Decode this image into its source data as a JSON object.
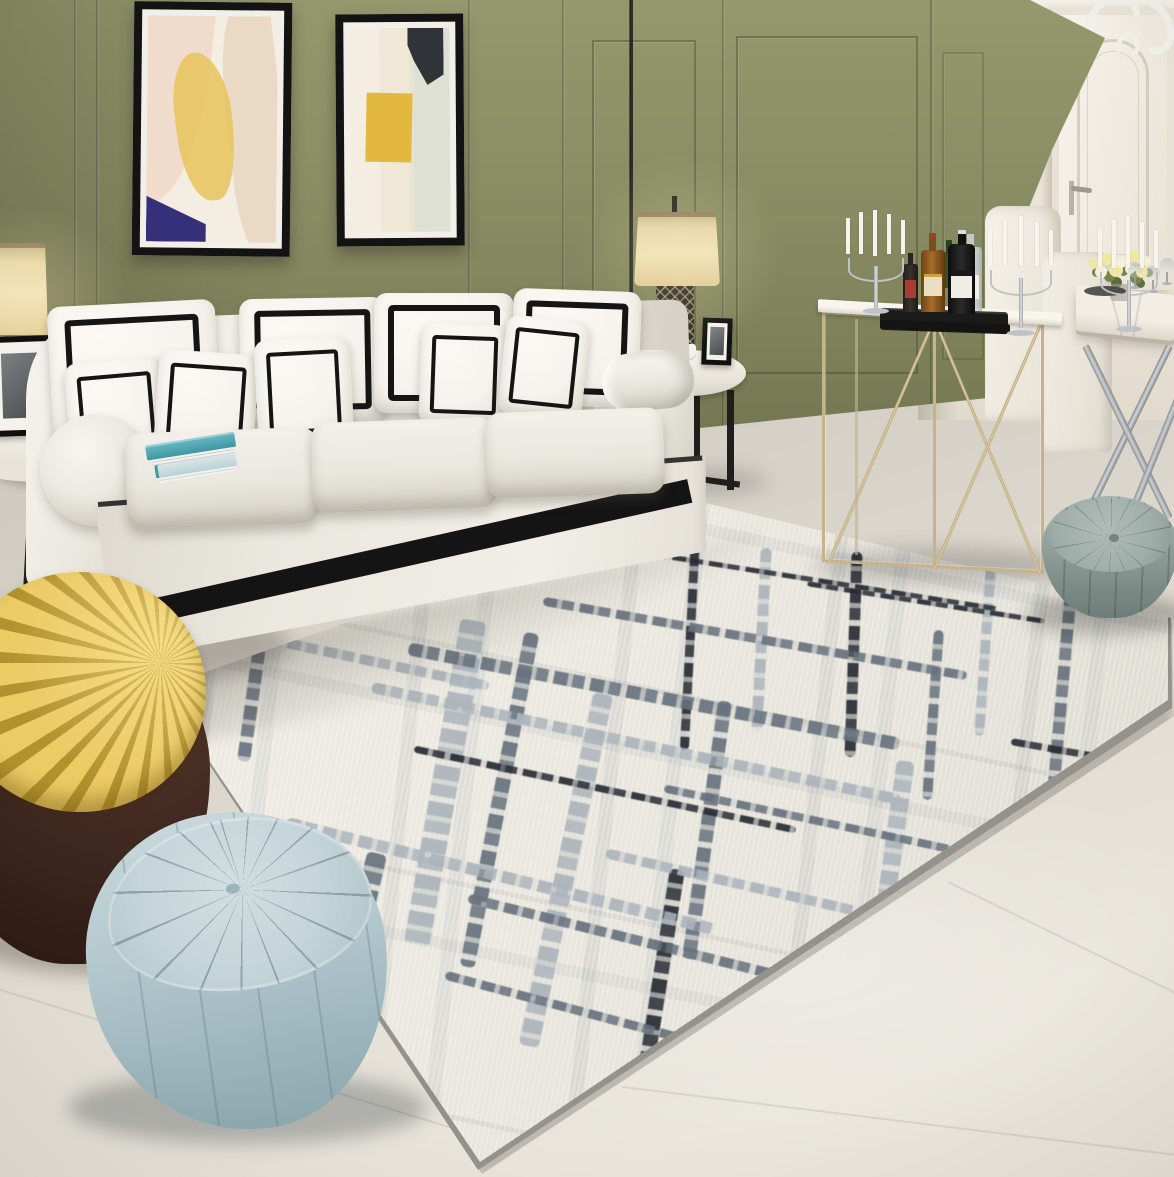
{
  "image": {
    "type": "interior photograph (product scene, no text)",
    "room": "modern living and dining room",
    "width_px": 1174,
    "height_px": 1177
  },
  "scene": {
    "description": "Living room staged around a cream abstract brushstroke area rug: white three-seat sofa with black-trim pillows against an olive-green paneled wall with two abstract artworks, gold console bar table with liquor bottles and silver candelabras, white door and dining nook at right, quilted poufs, and a yellow pleated lounge chair on a brown leather base.",
    "objects": [
      "olive green paneled wall",
      "abstract artwork left (blush, yellow, navy)",
      "abstract artwork right (yellow block, charcoal corner)",
      "white three-seat sofa with black piping and skirt stripe",
      "white throw pillows with black square trim",
      "stack of teal books on sofa arm",
      "floor lamp shade (left edge)",
      "table lamp with lattice base on round marble side table",
      "black picture frames",
      "round white side table with black frames (far left)",
      "cream abstract brushstroke area rug with grey and black strokes",
      "gold metal console table",
      "black tray with liquor bottles",
      "silver candelabras with white candles",
      "white paneled door",
      "white chandelier scroll (top right)",
      "marble dining table with chrome X legs",
      "white dining chairs",
      "yellow-white flower centerpiece and wine glasses",
      "grey-green round quilted pouf",
      "light blue quilted triangular pouf",
      "yellow pleated round chair with dark brown leather base",
      "beige tiled floor"
    ]
  },
  "palette": {
    "wall_green": "#888C63",
    "wall_green_dark": "#6E724E",
    "wall_green_light": "#94986C",
    "wall_white": "#EDE6D9",
    "ceiling": "#F4F0E7",
    "door": "#F3EFE7",
    "floor_mid": "#DBD6CC",
    "floor_dark": "#C8C3B8",
    "floor_light": "#EAE6DD",
    "rug_base": "#EDEAE1",
    "rug_slate": "#76828E",
    "rug_light": "#B2BAC1",
    "rug_dark": "#272C34",
    "rug_edge": "#93928B",
    "sofa_cream": "#EAE7DF",
    "sofa_shadow": "#CBC7BD",
    "pillow_white": "#F5F3ED",
    "ink": "#151515",
    "art_yellow": "#E7C35C",
    "art_blush": "#F1DCCB",
    "art_navy": "#36307A",
    "art_charcoal": "#303439",
    "art_sage": "#D9DDD1",
    "lamp_shade": "#EBDCB0",
    "gold": "#C7B28A",
    "gold_light": "#E3D4B0",
    "silver": "#BFC3C7",
    "chrome": "#A9AEB3",
    "marble": "#ECE8E0",
    "pouf_light": "#A3B1AC",
    "pouf_dark": "#76857F",
    "pouf2_light": "#C6D6DA",
    "pouf2_dark": "#8BA6AD",
    "chair_yellow": "#E5BF55",
    "chair_yellow_dark": "#B3922E",
    "ottoman_brown": "#3F2820",
    "ottoman_brown_light": "#5C392B",
    "book_teal": "#4FA9B5",
    "tray_black": "#1B1B19",
    "bottle_amber": "#8A5A22",
    "bottle_green": "#2F4A24",
    "bottle_red": "#A93B2F",
    "candle": "#F7F4ED",
    "flower": "#EDE8A6",
    "leaf": "#76844C"
  }
}
